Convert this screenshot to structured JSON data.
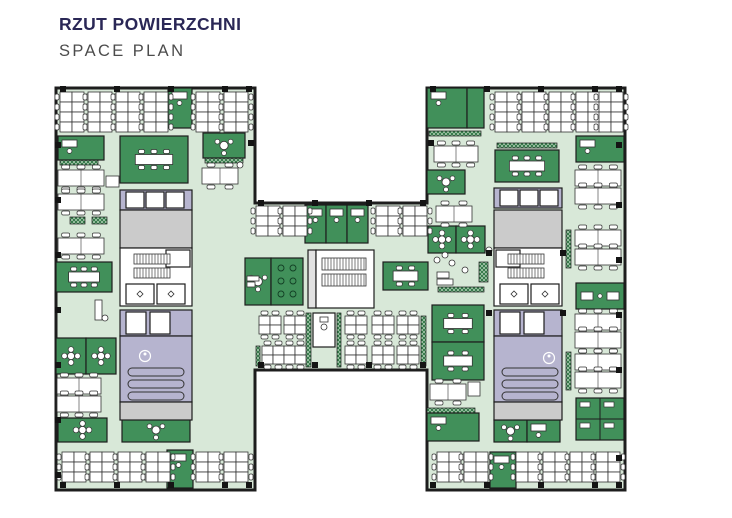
{
  "header": {
    "title": "RZUT POWIERZCHNI",
    "subtitle": "SPACE PLAN"
  },
  "palette": {
    "title_color": "#2a2756",
    "subtitle_color": "#4c4c4c",
    "floor": "#d8e8d8",
    "room_green": "#41905a",
    "planter_green": "#2c7443",
    "planter_line": "#cfe3cf",
    "lavender": "#b6b4cf",
    "gray": "#cbcbcb",
    "light_gray": "#e2e2e2",
    "white": "#ffffff",
    "wall": "#1d1d1d",
    "furniture_stroke": "#333333",
    "column": "#141414"
  },
  "plan": {
    "outline": [
      [
        56,
        88
      ],
      [
        255,
        88
      ],
      [
        255,
        203
      ],
      [
        427,
        203
      ],
      [
        427,
        88
      ],
      [
        625,
        88
      ],
      [
        625,
        490
      ],
      [
        427,
        490
      ],
      [
        427,
        370
      ],
      [
        255,
        370
      ],
      [
        255,
        490
      ],
      [
        56,
        490
      ]
    ],
    "rooms": [
      {
        "x": 168,
        "y": 88,
        "w": 24,
        "h": 40,
        "t": "g",
        "f": "desk"
      },
      {
        "x": 58,
        "y": 136,
        "w": 46,
        "h": 24,
        "t": "g",
        "f": "desk"
      },
      {
        "x": 120,
        "y": 136,
        "w": 68,
        "h": 47,
        "t": "g",
        "f": "conf"
      },
      {
        "x": 203,
        "y": 133,
        "w": 42,
        "h": 25,
        "t": "g",
        "f": "round"
      },
      {
        "x": 56,
        "y": 262,
        "w": 56,
        "h": 30,
        "t": "g",
        "f": "conf"
      },
      {
        "x": 56,
        "y": 338,
        "w": 30,
        "h": 36,
        "t": "g",
        "f": "clover"
      },
      {
        "x": 86,
        "y": 338,
        "w": 30,
        "h": 36,
        "t": "g",
        "f": "clover"
      },
      {
        "x": 58,
        "y": 418,
        "w": 49,
        "h": 24,
        "t": "g",
        "f": "clover"
      },
      {
        "x": 122,
        "y": 418,
        "w": 68,
        "h": 24,
        "t": "g",
        "f": "round"
      },
      {
        "x": 167,
        "y": 450,
        "w": 26,
        "h": 38,
        "t": "g",
        "f": "desk"
      },
      {
        "x": 120,
        "y": 190,
        "w": 72,
        "h": 20,
        "t": "l"
      },
      {
        "x": 126,
        "y": 192,
        "w": 18,
        "h": 16,
        "t": "w"
      },
      {
        "x": 146,
        "y": 192,
        "w": 18,
        "h": 16,
        "t": "w"
      },
      {
        "x": 166,
        "y": 192,
        "w": 18,
        "h": 16,
        "t": "w"
      },
      {
        "x": 120,
        "y": 210,
        "w": 72,
        "h": 38,
        "t": "gy"
      },
      {
        "x": 120,
        "y": 248,
        "w": 72,
        "h": 58,
        "t": "w"
      },
      {
        "x": 166,
        "y": 250,
        "w": 24,
        "h": 17,
        "t": "w"
      },
      {
        "x": 126,
        "y": 284,
        "w": 28,
        "h": 20,
        "t": "w",
        "f": "dr"
      },
      {
        "x": 157,
        "y": 284,
        "w": 28,
        "h": 20,
        "t": "w",
        "f": "dr"
      },
      {
        "x": 120,
        "y": 310,
        "w": 72,
        "h": 26,
        "t": "l"
      },
      {
        "x": 126,
        "y": 312,
        "w": 20,
        "h": 22,
        "t": "w"
      },
      {
        "x": 150,
        "y": 312,
        "w": 20,
        "h": 22,
        "t": "w"
      },
      {
        "x": 120,
        "y": 336,
        "w": 72,
        "h": 66,
        "t": "l"
      },
      {
        "x": 120,
        "y": 402,
        "w": 72,
        "h": 18,
        "t": "gy"
      },
      {
        "x": 245,
        "y": 258,
        "w": 26,
        "h": 47,
        "t": "g",
        "f": "round"
      },
      {
        "x": 271,
        "y": 258,
        "w": 32,
        "h": 47,
        "t": "g",
        "f": "plants"
      },
      {
        "x": 305,
        "y": 205,
        "w": 21,
        "h": 38,
        "t": "g",
        "f": "desk"
      },
      {
        "x": 326,
        "y": 205,
        "w": 21,
        "h": 38,
        "t": "g",
        "f": "desk"
      },
      {
        "x": 347,
        "y": 205,
        "w": 21,
        "h": 38,
        "t": "g",
        "f": "desk"
      },
      {
        "x": 308,
        "y": 250,
        "w": 8,
        "h": 58,
        "t": "lg"
      },
      {
        "x": 316,
        "y": 250,
        "w": 58,
        "h": 58,
        "t": "w"
      },
      {
        "x": 383,
        "y": 262,
        "w": 45,
        "h": 28,
        "t": "g",
        "f": "conf"
      },
      {
        "x": 313,
        "y": 313,
        "w": 22,
        "h": 34,
        "t": "w",
        "f": "wc"
      },
      {
        "x": 428,
        "y": 226,
        "w": 28,
        "h": 27,
        "t": "g",
        "f": "clover"
      },
      {
        "x": 456,
        "y": 226,
        "w": 29,
        "h": 27,
        "t": "g",
        "f": "clover"
      },
      {
        "x": 432,
        "y": 305,
        "w": 52,
        "h": 37,
        "t": "g",
        "f": "conf"
      },
      {
        "x": 432,
        "y": 342,
        "w": 52,
        "h": 38,
        "t": "g",
        "f": "conf"
      },
      {
        "x": 427,
        "y": 88,
        "w": 40,
        "h": 40,
        "t": "g",
        "f": "desk"
      },
      {
        "x": 467,
        "y": 88,
        "w": 17,
        "h": 40,
        "t": "g"
      },
      {
        "x": 427,
        "y": 170,
        "w": 38,
        "h": 24,
        "t": "g",
        "f": "round"
      },
      {
        "x": 495,
        "y": 150,
        "w": 64,
        "h": 32,
        "t": "g",
        "f": "conf"
      },
      {
        "x": 576,
        "y": 136,
        "w": 48,
        "h": 26,
        "t": "g",
        "f": "desk"
      },
      {
        "x": 576,
        "y": 283,
        "w": 48,
        "h": 26,
        "t": "g",
        "f": "desk2"
      },
      {
        "x": 576,
        "y": 398,
        "w": 48,
        "h": 42,
        "t": "g",
        "f": "x4"
      },
      {
        "x": 427,
        "y": 413,
        "w": 52,
        "h": 28,
        "t": "g",
        "f": "desk"
      },
      {
        "x": 494,
        "y": 420,
        "w": 33,
        "h": 22,
        "t": "g",
        "f": "round"
      },
      {
        "x": 527,
        "y": 420,
        "w": 33,
        "h": 22,
        "t": "g",
        "f": "desk"
      },
      {
        "x": 490,
        "y": 452,
        "w": 26,
        "h": 36,
        "t": "g",
        "f": "desk"
      },
      {
        "x": 494,
        "y": 188,
        "w": 68,
        "h": 20,
        "t": "l"
      },
      {
        "x": 500,
        "y": 190,
        "w": 18,
        "h": 16,
        "t": "w"
      },
      {
        "x": 520,
        "y": 190,
        "w": 18,
        "h": 16,
        "t": "w"
      },
      {
        "x": 540,
        "y": 190,
        "w": 18,
        "h": 16,
        "t": "w"
      },
      {
        "x": 494,
        "y": 210,
        "w": 68,
        "h": 38,
        "t": "gy"
      },
      {
        "x": 494,
        "y": 248,
        "w": 68,
        "h": 58,
        "t": "w"
      },
      {
        "x": 496,
        "y": 250,
        "w": 24,
        "h": 17,
        "t": "w"
      },
      {
        "x": 500,
        "y": 284,
        "w": 28,
        "h": 20,
        "t": "w",
        "f": "dr"
      },
      {
        "x": 531,
        "y": 284,
        "w": 28,
        "h": 20,
        "t": "w",
        "f": "dr"
      },
      {
        "x": 494,
        "y": 310,
        "w": 68,
        "h": 26,
        "t": "l"
      },
      {
        "x": 500,
        "y": 312,
        "w": 20,
        "h": 22,
        "t": "w"
      },
      {
        "x": 524,
        "y": 312,
        "w": 20,
        "h": 22,
        "t": "w"
      },
      {
        "x": 494,
        "y": 336,
        "w": 68,
        "h": 66,
        "t": "l"
      },
      {
        "x": 494,
        "y": 402,
        "w": 68,
        "h": 18,
        "t": "gy"
      }
    ],
    "stairs": [
      {
        "x": 134,
        "y": 254,
        "w": 36,
        "h": 10
      },
      {
        "x": 134,
        "y": 268,
        "w": 36,
        "h": 10
      },
      {
        "x": 508,
        "y": 254,
        "w": 36,
        "h": 10
      },
      {
        "x": 508,
        "y": 268,
        "w": 36,
        "h": 10
      },
      {
        "x": 322,
        "y": 258,
        "w": 44,
        "h": 12
      },
      {
        "x": 322,
        "y": 274,
        "w": 44,
        "h": 12
      }
    ],
    "stair_bars": [
      {
        "x": 128,
        "y": 368,
        "w": 56,
        "h": 8
      },
      {
        "x": 128,
        "y": 380,
        "w": 56,
        "h": 8
      },
      {
        "x": 128,
        "y": 392,
        "w": 56,
        "h": 8
      },
      {
        "x": 502,
        "y": 368,
        "w": 56,
        "h": 8
      },
      {
        "x": 502,
        "y": 380,
        "w": 56,
        "h": 8
      },
      {
        "x": 502,
        "y": 392,
        "w": 56,
        "h": 8
      }
    ],
    "planters": [
      {
        "x": 60,
        "y": 160,
        "w": 38,
        "h": 5
      },
      {
        "x": 122,
        "y": 139,
        "w": 56,
        "h": 5
      },
      {
        "x": 205,
        "y": 158,
        "w": 38,
        "h": 5
      },
      {
        "x": 58,
        "y": 284,
        "w": 30,
        "h": 5
      },
      {
        "x": 70,
        "y": 217,
        "w": 15,
        "h": 7
      },
      {
        "x": 92,
        "y": 217,
        "w": 15,
        "h": 7
      },
      {
        "x": 429,
        "y": 131,
        "w": 52,
        "h": 5
      },
      {
        "x": 497,
        "y": 143,
        "w": 60,
        "h": 5
      },
      {
        "x": 438,
        "y": 287,
        "w": 46,
        "h": 5
      },
      {
        "x": 427,
        "y": 408,
        "w": 48,
        "h": 5
      },
      {
        "x": 479,
        "y": 262,
        "w": 9,
        "h": 20
      },
      {
        "x": 306,
        "y": 313,
        "w": 5,
        "h": 54
      },
      {
        "x": 337,
        "y": 313,
        "w": 4,
        "h": 54
      },
      {
        "x": 421,
        "y": 316,
        "w": 5,
        "h": 50
      },
      {
        "x": 256,
        "y": 346,
        "w": 4,
        "h": 20
      },
      {
        "x": 566,
        "y": 230,
        "w": 5,
        "h": 38
      },
      {
        "x": 566,
        "y": 352,
        "w": 5,
        "h": 38
      }
    ],
    "vclusters": [
      {
        "x": 60,
        "y": 92,
        "r": 4
      },
      {
        "x": 88,
        "y": 92,
        "r": 4
      },
      {
        "x": 116,
        "y": 92,
        "r": 4
      },
      {
        "x": 144,
        "y": 92,
        "r": 4
      },
      {
        "x": 196,
        "y": 92,
        "r": 4
      },
      {
        "x": 224,
        "y": 92,
        "r": 4
      },
      {
        "x": 495,
        "y": 92,
        "r": 4
      },
      {
        "x": 522,
        "y": 92,
        "r": 4
      },
      {
        "x": 549,
        "y": 92,
        "r": 4
      },
      {
        "x": 576,
        "y": 92,
        "r": 4
      },
      {
        "x": 599,
        "y": 92,
        "r": 4
      },
      {
        "x": 62,
        "y": 452,
        "r": 3
      },
      {
        "x": 90,
        "y": 452,
        "r": 3
      },
      {
        "x": 118,
        "y": 452,
        "r": 3
      },
      {
        "x": 146,
        "y": 452,
        "r": 3
      },
      {
        "x": 196,
        "y": 452,
        "r": 3
      },
      {
        "x": 224,
        "y": 452,
        "r": 3
      },
      {
        "x": 437,
        "y": 452,
        "r": 3
      },
      {
        "x": 464,
        "y": 452,
        "r": 3
      },
      {
        "x": 516,
        "y": 452,
        "r": 3
      },
      {
        "x": 543,
        "y": 452,
        "r": 3
      },
      {
        "x": 570,
        "y": 452,
        "r": 3
      },
      {
        "x": 596,
        "y": 452,
        "r": 3
      },
      {
        "x": 256,
        "y": 206,
        "r": 3
      },
      {
        "x": 283,
        "y": 206,
        "r": 3
      },
      {
        "x": 376,
        "y": 206,
        "r": 3
      },
      {
        "x": 403,
        "y": 206,
        "r": 3
      }
    ],
    "qclusters": [
      {
        "x": 259,
        "y": 316
      },
      {
        "x": 284,
        "y": 316
      },
      {
        "x": 345,
        "y": 316
      },
      {
        "x": 372,
        "y": 316
      },
      {
        "x": 397,
        "y": 316
      },
      {
        "x": 262,
        "y": 346
      },
      {
        "x": 284,
        "y": 346
      },
      {
        "x": 345,
        "y": 346
      },
      {
        "x": 372,
        "y": 346
      },
      {
        "x": 397,
        "y": 346
      }
    ],
    "benches": [
      {
        "x": 58,
        "y": 170,
        "w": 46
      },
      {
        "x": 58,
        "y": 194,
        "w": 46
      },
      {
        "x": 58,
        "y": 238,
        "w": 46
      },
      {
        "x": 57,
        "y": 378,
        "w": 44
      },
      {
        "x": 57,
        "y": 396,
        "w": 44
      },
      {
        "x": 202,
        "y": 168,
        "w": 36
      },
      {
        "x": 434,
        "y": 146,
        "w": 44
      },
      {
        "x": 436,
        "y": 206,
        "w": 36
      },
      {
        "x": 430,
        "y": 384,
        "w": 36
      },
      {
        "x": 575,
        "y": 170,
        "w": 46
      },
      {
        "x": 575,
        "y": 188,
        "w": 46
      },
      {
        "x": 575,
        "y": 230,
        "w": 46
      },
      {
        "x": 575,
        "y": 249,
        "w": 46
      },
      {
        "x": 575,
        "y": 314,
        "w": 46
      },
      {
        "x": 575,
        "y": 332,
        "w": 46
      },
      {
        "x": 575,
        "y": 354,
        "w": 46
      },
      {
        "x": 575,
        "y": 372,
        "w": 46
      }
    ],
    "misc_rects": [
      {
        "x": 106,
        "y": 176,
        "w": 13,
        "h": 11
      },
      {
        "x": 95,
        "y": 300,
        "w": 7,
        "h": 20
      },
      {
        "x": 468,
        "y": 382,
        "w": 12,
        "h": 14
      },
      {
        "x": 437,
        "y": 272,
        "w": 12,
        "h": 6
      },
      {
        "x": 437,
        "y": 279,
        "w": 16,
        "h": 6
      },
      {
        "x": 247,
        "y": 276,
        "w": 12,
        "h": 5
      },
      {
        "x": 247,
        "y": 282,
        "w": 8,
        "h": 5
      }
    ],
    "dots": [
      {
        "x": 437,
        "y": 260
      },
      {
        "x": 445,
        "y": 255
      },
      {
        "x": 452,
        "y": 263
      },
      {
        "x": 465,
        "y": 270
      },
      {
        "x": 105,
        "y": 318
      },
      {
        "x": 240,
        "y": 165
      },
      {
        "x": 489,
        "y": 250
      }
    ],
    "columns": [
      [
        60,
        86
      ],
      [
        114,
        86
      ],
      [
        168,
        86
      ],
      [
        222,
        86
      ],
      [
        246,
        86
      ],
      [
        430,
        86
      ],
      [
        484,
        86
      ],
      [
        538,
        86
      ],
      [
        592,
        86
      ],
      [
        616,
        86
      ],
      [
        55,
        142
      ],
      [
        55,
        197
      ],
      [
        55,
        252
      ],
      [
        55,
        307
      ],
      [
        55,
        362
      ],
      [
        55,
        417
      ],
      [
        55,
        472
      ],
      [
        616,
        142
      ],
      [
        616,
        202
      ],
      [
        616,
        257
      ],
      [
        616,
        312
      ],
      [
        616,
        367
      ],
      [
        616,
        455
      ],
      [
        60,
        482
      ],
      [
        114,
        482
      ],
      [
        168,
        482
      ],
      [
        222,
        482
      ],
      [
        246,
        482
      ],
      [
        430,
        482
      ],
      [
        484,
        482
      ],
      [
        538,
        482
      ],
      [
        592,
        482
      ],
      [
        616,
        482
      ],
      [
        258,
        200
      ],
      [
        312,
        200
      ],
      [
        366,
        200
      ],
      [
        420,
        200
      ],
      [
        258,
        362
      ],
      [
        312,
        362
      ],
      [
        366,
        362
      ],
      [
        420,
        362
      ],
      [
        248,
        140
      ],
      [
        428,
        140
      ],
      [
        486,
        250
      ],
      [
        560,
        250
      ],
      [
        486,
        310
      ],
      [
        560,
        310
      ]
    ],
    "ada": [
      {
        "cx": 145,
        "cy": 356
      },
      {
        "cx": 549,
        "cy": 358
      }
    ]
  }
}
